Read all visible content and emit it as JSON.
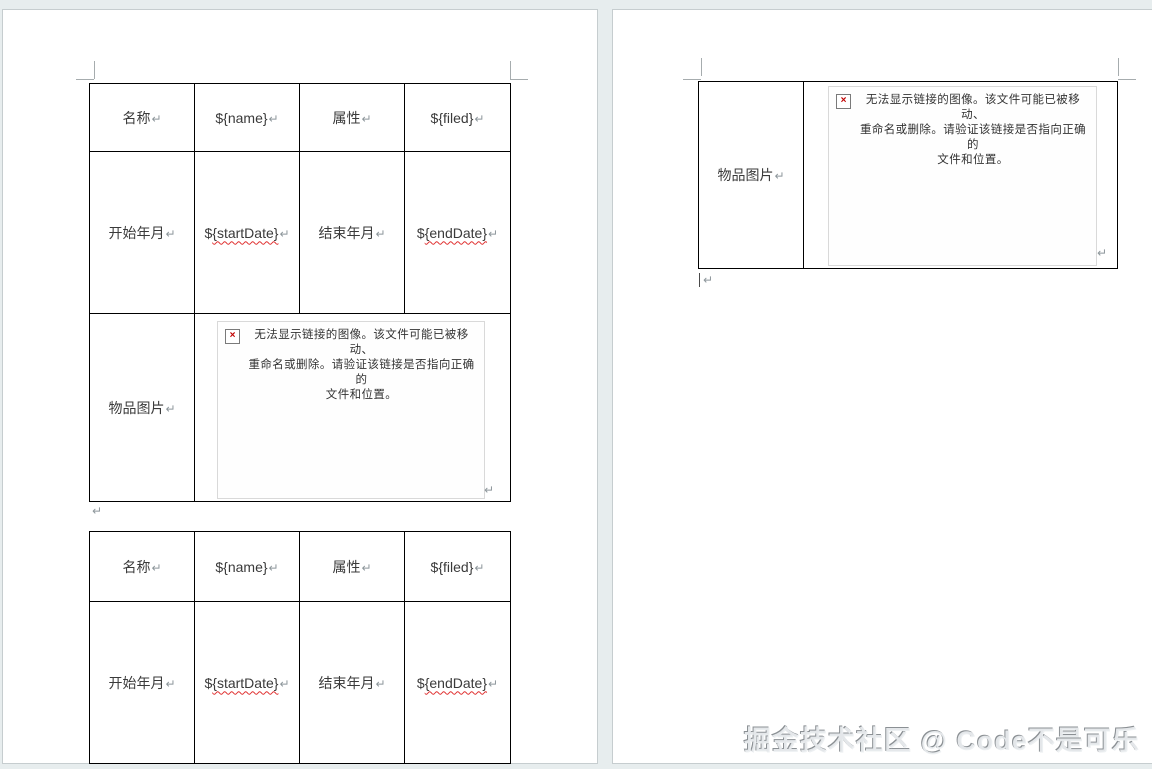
{
  "page1": {
    "table_top": {
      "r1c1": "名称",
      "r1c2": "${name}",
      "r1c3": "属性",
      "r1c4": "${filed}",
      "r2c1": "开始年月",
      "r2c2_prefix": "$",
      "r2c2_body": "{startDate}",
      "r2c3": "结束年月",
      "r2c4_prefix": "$",
      "r2c4_body": "{endDate}",
      "r3c1": "物品图片"
    },
    "table_bottom": {
      "r1c1": "名称",
      "r1c2": "${name}",
      "r1c3": "属性",
      "r1c4": "${filed}",
      "r2c1": "开始年月",
      "r2c2_prefix": "$",
      "r2c2_body": "{startDate}",
      "r2c3": "结束年月",
      "r2c4_prefix": "$",
      "r2c4_body": "{endDate}"
    }
  },
  "page2": {
    "table": {
      "r1c1": "物品图片"
    }
  },
  "broken_image": {
    "line1": "无法显示链接的图像。该文件可能已被移动、",
    "line2": "重命名或删除。请验证该链接是否指向正确的",
    "line3": "文件和位置。",
    "x_glyph": "×"
  },
  "marks": {
    "pilcrow": "↵"
  },
  "watermark": {
    "text": "掘金技术社区 @ Code不是可乐"
  },
  "colors": {
    "background": "#e7edee",
    "table_border": "#000000",
    "error_red": "#c00000",
    "spellcheck_red": "#e03030",
    "placeholder_border": "#d9d9d9"
  }
}
